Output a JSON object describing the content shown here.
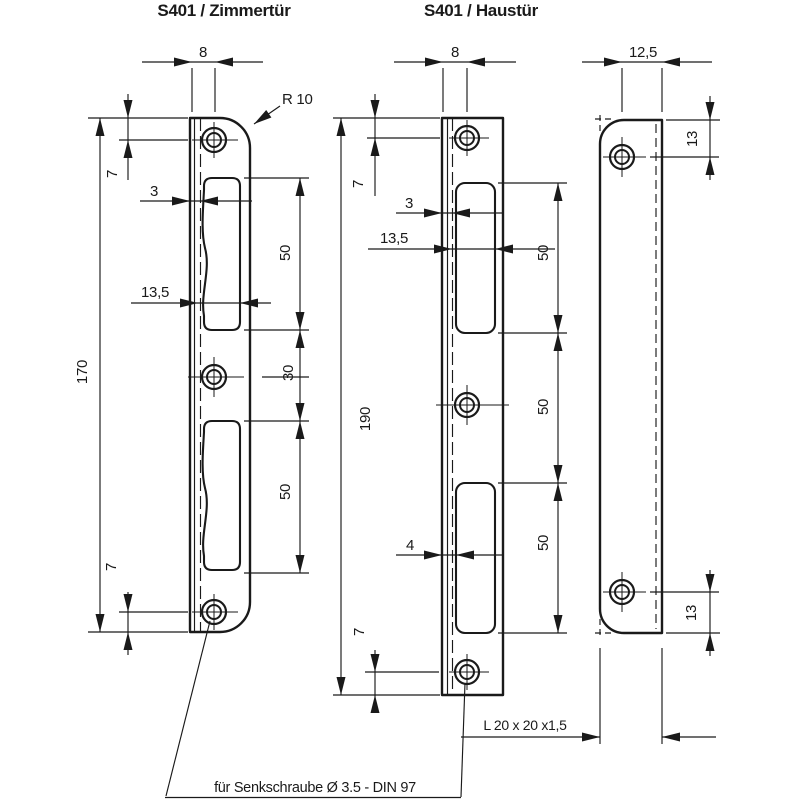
{
  "colors": {
    "ink": "#1a1a1a",
    "background": "#ffffff"
  },
  "titles": {
    "zimmertuer": "S401 / Zimmertür",
    "haustuer": "S401 / Haustür"
  },
  "zimmertuer_view": {
    "plate_width": "8",
    "corner_radius": "R 10",
    "hole_top_offset": "7",
    "lip_to_cutout": "3",
    "cutout_width": "13,5",
    "plate_height": "170",
    "latch_cutout_height": "50",
    "cutout_gap": "30",
    "bolt_cutout_height": "50",
    "hole_bottom_offset": "7"
  },
  "haustuer_front_view": {
    "plate_width": "8",
    "hole_top_offset": "7",
    "lip_to_cutout": "3",
    "cutout_width": "13,5",
    "plate_height": "190",
    "latch_cutout_height": "50",
    "cutout_gap": "50",
    "bolt_cutout_height": "50",
    "bolt_lip_to_cutout": "4",
    "hole_bottom_offset": "7"
  },
  "haustuer_side_view": {
    "flange_width": "12,5",
    "hole_top_offset": "13",
    "hole_bottom_offset": "13"
  },
  "annotations": {
    "profile": "L 20 x 20 x1,5",
    "screw_note": "für Senkschraube Ø 3.5 - DIN 97"
  }
}
